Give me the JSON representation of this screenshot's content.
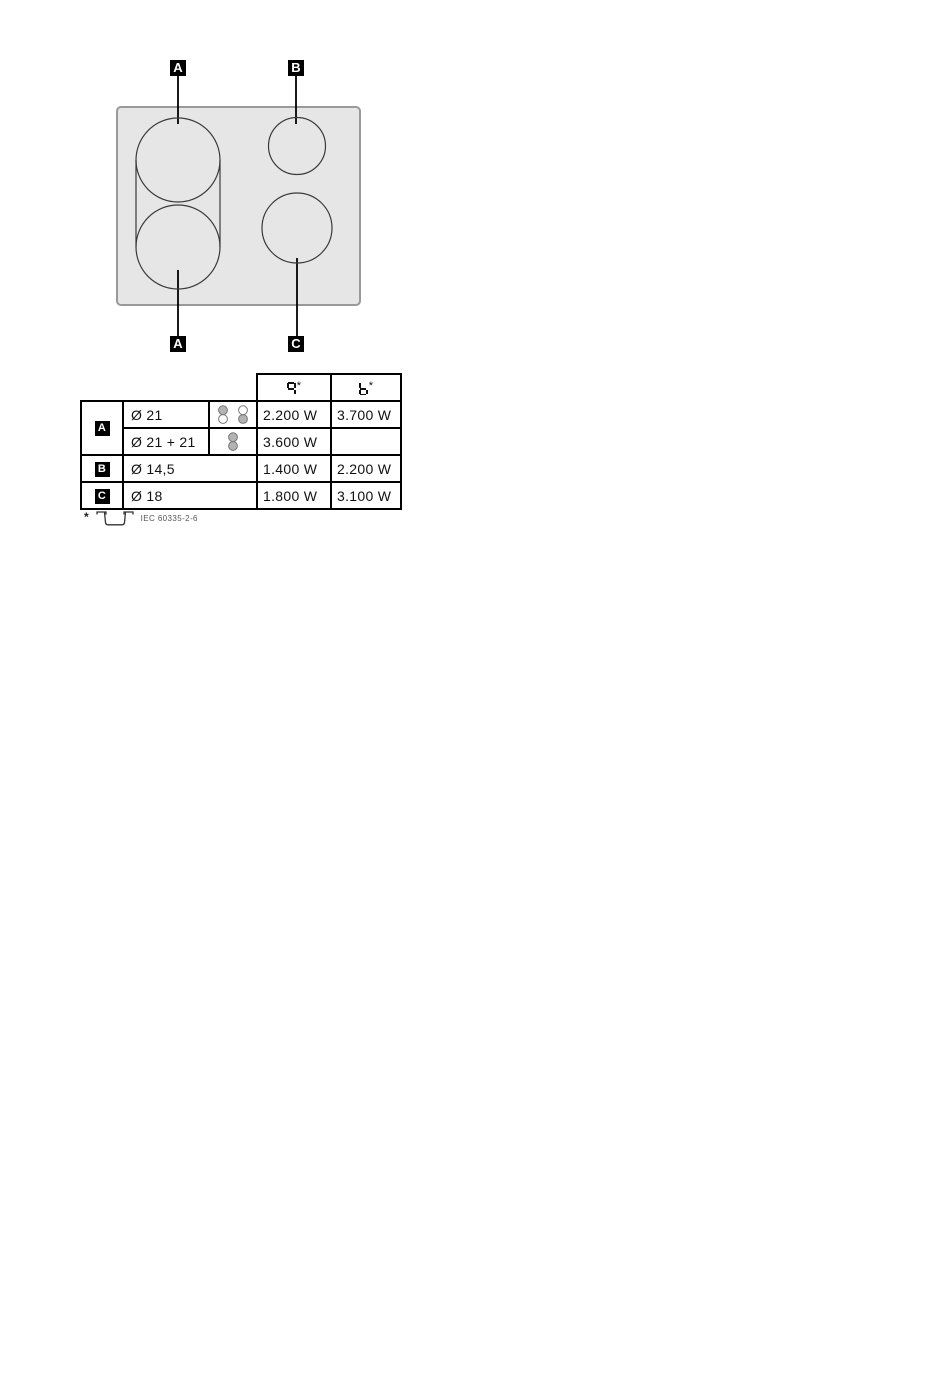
{
  "colors": {
    "surface": "#e6e6e6",
    "surface_border": "#999999",
    "line": "#000000",
    "badge_bg": "#000000",
    "badge_fg": "#ffffff",
    "zone_icon_fill": "#b3b3b3",
    "footnote_text": "#555555"
  },
  "diagram": {
    "labels": [
      {
        "letter": "A",
        "position": "top-left"
      },
      {
        "letter": "B",
        "position": "top-right"
      },
      {
        "letter": "A",
        "position": "bottom-left"
      },
      {
        "letter": "C",
        "position": "bottom-right"
      }
    ]
  },
  "table": {
    "header": {
      "columns": [
        {
          "display": "9*",
          "glyph": "9",
          "suffix": "*",
          "segments": [
            "a",
            "b",
            "c",
            "f",
            "g"
          ],
          "icon": "seven-segment-9-icon"
        },
        {
          "display": "b*",
          "glyph": "b",
          "suffix": "*",
          "segments": [
            "c",
            "d",
            "e",
            "f",
            "g"
          ],
          "icon": "seven-segment-b-icon"
        }
      ]
    },
    "rows": [
      {
        "label": "A",
        "diameter": "Ø 21",
        "icons": [
          "rear-zone-selected-icon",
          "front-zone-selected-icon"
        ],
        "power_9": "2.200 W",
        "power_b": "3.700 W"
      },
      {
        "diameter": "Ø 21 + 21",
        "icons": [
          "both-zones-selected-icon"
        ],
        "power_9": "3.600 W",
        "power_b": ""
      },
      {
        "label": "B",
        "diameter": "Ø 14,5",
        "icons": [],
        "power_9": "1.400 W",
        "power_b": "2.200 W"
      },
      {
        "label": "C",
        "diameter": "Ø 18",
        "icons": [],
        "power_9": "1.800 W",
        "power_b": "3.100 W"
      }
    ]
  },
  "footnote": {
    "marker": "*",
    "icon": "cookware-pan-icon",
    "standard": "IEC 60335-2-6"
  }
}
